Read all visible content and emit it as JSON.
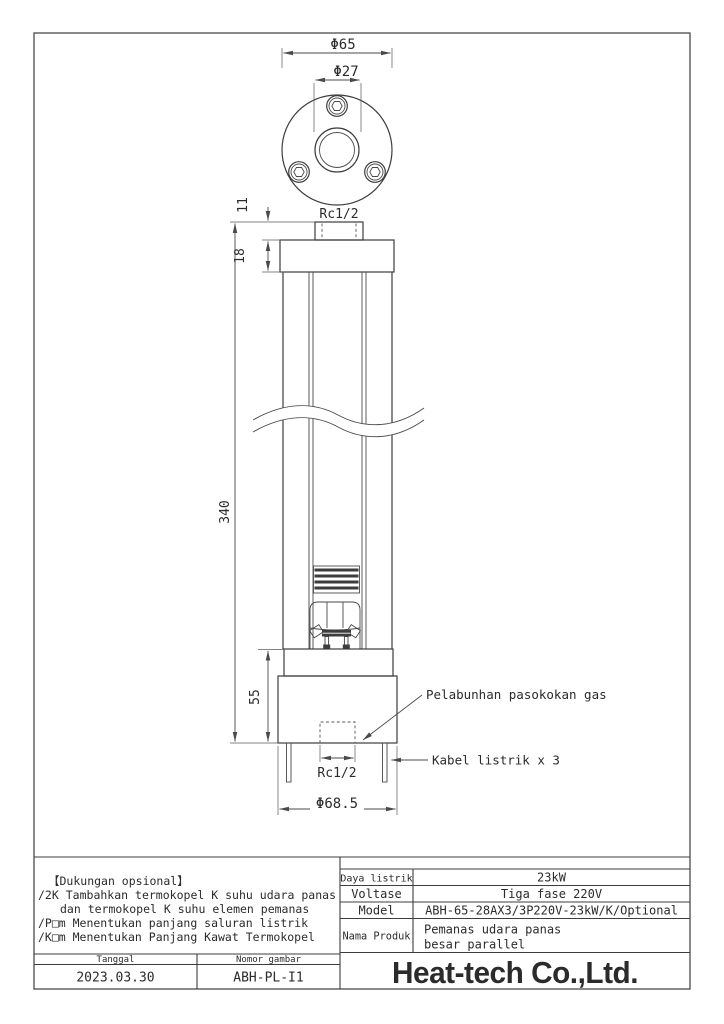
{
  "drawing": {
    "top_view": {
      "dim_outer_diameter": "Φ65",
      "dim_hole_diameter": "Φ27"
    },
    "side_view": {
      "top_fitting_thread": "Rc1/2",
      "dim_fitting_height": "11",
      "dim_flange_thickness": "18",
      "dim_body_length": "340",
      "dim_base_height": "55",
      "bottom_port_thread": "Rc1/2",
      "dim_base_diameter": "Φ68.5"
    },
    "callouts": {
      "gas_supply": "Pelabunhan pasokokan gas",
      "power_cables": "Kabel listrik x 3"
    }
  },
  "optional_notes": {
    "title": "【Dukungan opsional】",
    "lines": [
      "/2K Tambahkan termokopel K suhu udara panas",
      "dan termokopel K suhu elemen pemanas",
      "/P□m Menentukan panjang saluran listrik",
      "/K□m Menentukan Panjang Kawat Termokopel"
    ]
  },
  "title_block": {
    "specs": [
      {
        "label": "Daya listrik",
        "value": "23kW"
      },
      {
        "label": "Voltase",
        "value": "Tiga fase 220V"
      },
      {
        "label": "Model",
        "value": "ABH-65-28AX3/3P220V-23kW/K/Optional"
      },
      {
        "label": "Nama Produk",
        "value_line1": "Pemanas udara panas",
        "value_line2": "besar parallel"
      }
    ],
    "date_label": "Tanggal",
    "date_value": "2023.03.30",
    "number_label": "Nomor gambar",
    "number_value": "ABH-PL-I1",
    "company": "Heat-tech Co.,Ltd."
  },
  "colors": {
    "logo_red": "#e8000f",
    "line": "#3d3d3d"
  }
}
